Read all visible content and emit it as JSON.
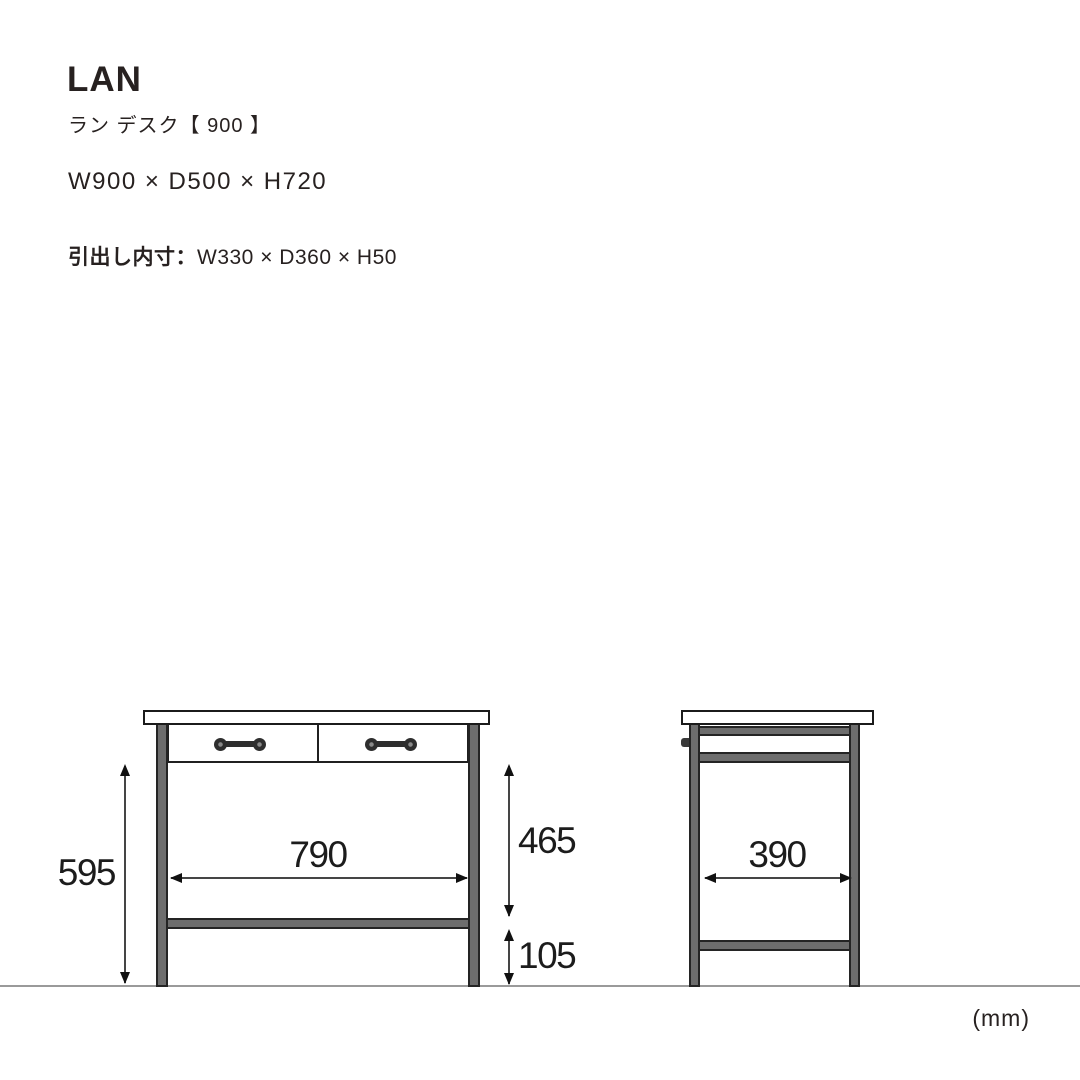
{
  "product": {
    "name": "LAN",
    "name_ja": "ラン デスク【 900 】",
    "overall_size": "W900 × D500 × H720",
    "drawer_inner_label": "引出し内寸：",
    "drawer_inner_size": "W330 × D360 × H50"
  },
  "diagram": {
    "unit": "(mm)",
    "front_view": {
      "leg_height": "595",
      "inner_width": "790",
      "under_drawer_height": "465",
      "stretcher_clearance": "105"
    },
    "side_view": {
      "inner_depth": "390"
    },
    "colors": {
      "frame_gray": "#6d6d6d",
      "outline_black": "#1b1b1b",
      "ground_gray": "#9a9a9a",
      "text_dark": "#272120"
    }
  }
}
